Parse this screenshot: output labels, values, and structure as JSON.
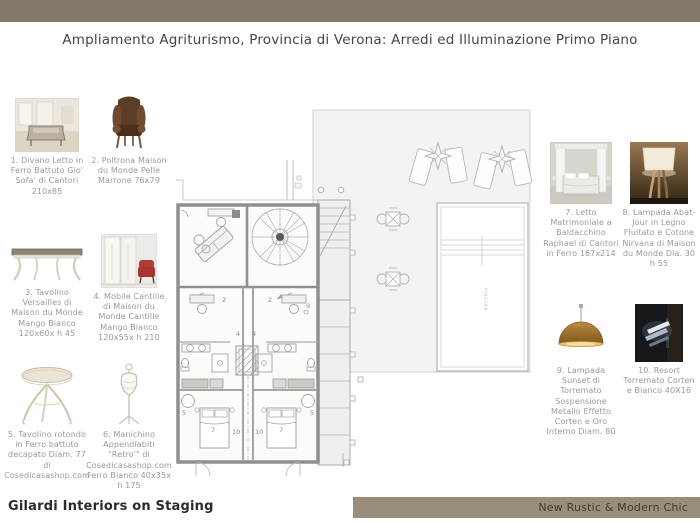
{
  "header": {
    "title": "Ampliamento Agriturismo, Provincia di Verona: Arredi ed Illuminazione Primo Piano"
  },
  "footer": {
    "left": "Gilardi Interiors on Staging",
    "right": "New Rustic & Modern Chic"
  },
  "colors": {
    "top_bar": "#84786a",
    "footer_bar": "#9a8d7c",
    "caption_text": "#9a9a9a",
    "corten_gold": "#a9792f",
    "leather_brown": "#5e3d26"
  },
  "catalog": {
    "left": [
      {
        "id": "1",
        "thumb": "sofa-bed-photo",
        "caption": "1. Divano Letto in Ferro Battuto Gio' Sofa' di Cantori 210x85"
      },
      {
        "id": "2",
        "thumb": "armchair-photo",
        "caption": "2. Poltrona Maison du Monde Pelle Marrone 76x79"
      },
      {
        "id": "3",
        "thumb": "console-table-photo",
        "caption": "3. Tavolino Versailles di Maison du Monde Mango Bianco 120x60x h 45"
      },
      {
        "id": "4",
        "thumb": "cabinet-photo",
        "caption": "4. Mobile Cantille di Maison du Monde Cantille Mango Bianco 120x55x h 210"
      },
      {
        "id": "5",
        "thumb": "round-table-photo",
        "caption": "5. Tavolino rotondo in Ferro battuto decapato Diam. 77 di Cosedicasashop.com"
      },
      {
        "id": "6",
        "thumb": "mannequin-rack-photo",
        "caption": "6. Manichino Appendiabiti \"Retro'\" di Cosedicasashop.com Ferro Bianco 40x35x h 175"
      }
    ],
    "right": [
      {
        "id": "7",
        "thumb": "canopy-bed-photo",
        "caption": "7. Letto Matrimoniale a Baldacchino Raphael di Cantori in Ferro 167x214"
      },
      {
        "id": "8",
        "thumb": "abat-jour-lamp-photo",
        "caption": "8. Lampada Abat-Jour in Legno Fluitato e Cotone Nirvana di Maison du Monde Dia. 30 h 55"
      },
      {
        "id": "9",
        "thumb": "sunset-pendant-photo",
        "caption": "9. Lampada Sunset di Torremato Sospensione Metallo Effetto Corten e Oro Interno Diam. 80"
      },
      {
        "id": "10",
        "thumb": "resort-wall-lamp-photo",
        "caption": "10. Resort Torremato Corten e Bianco 40X16"
      }
    ]
  },
  "plan": {
    "pool_label": "PISCINA",
    "labels": {
      "bed": "7",
      "console": "4",
      "armchair": "2",
      "side_table": "5",
      "wall_lamp": "10",
      "pendant": "9"
    }
  }
}
